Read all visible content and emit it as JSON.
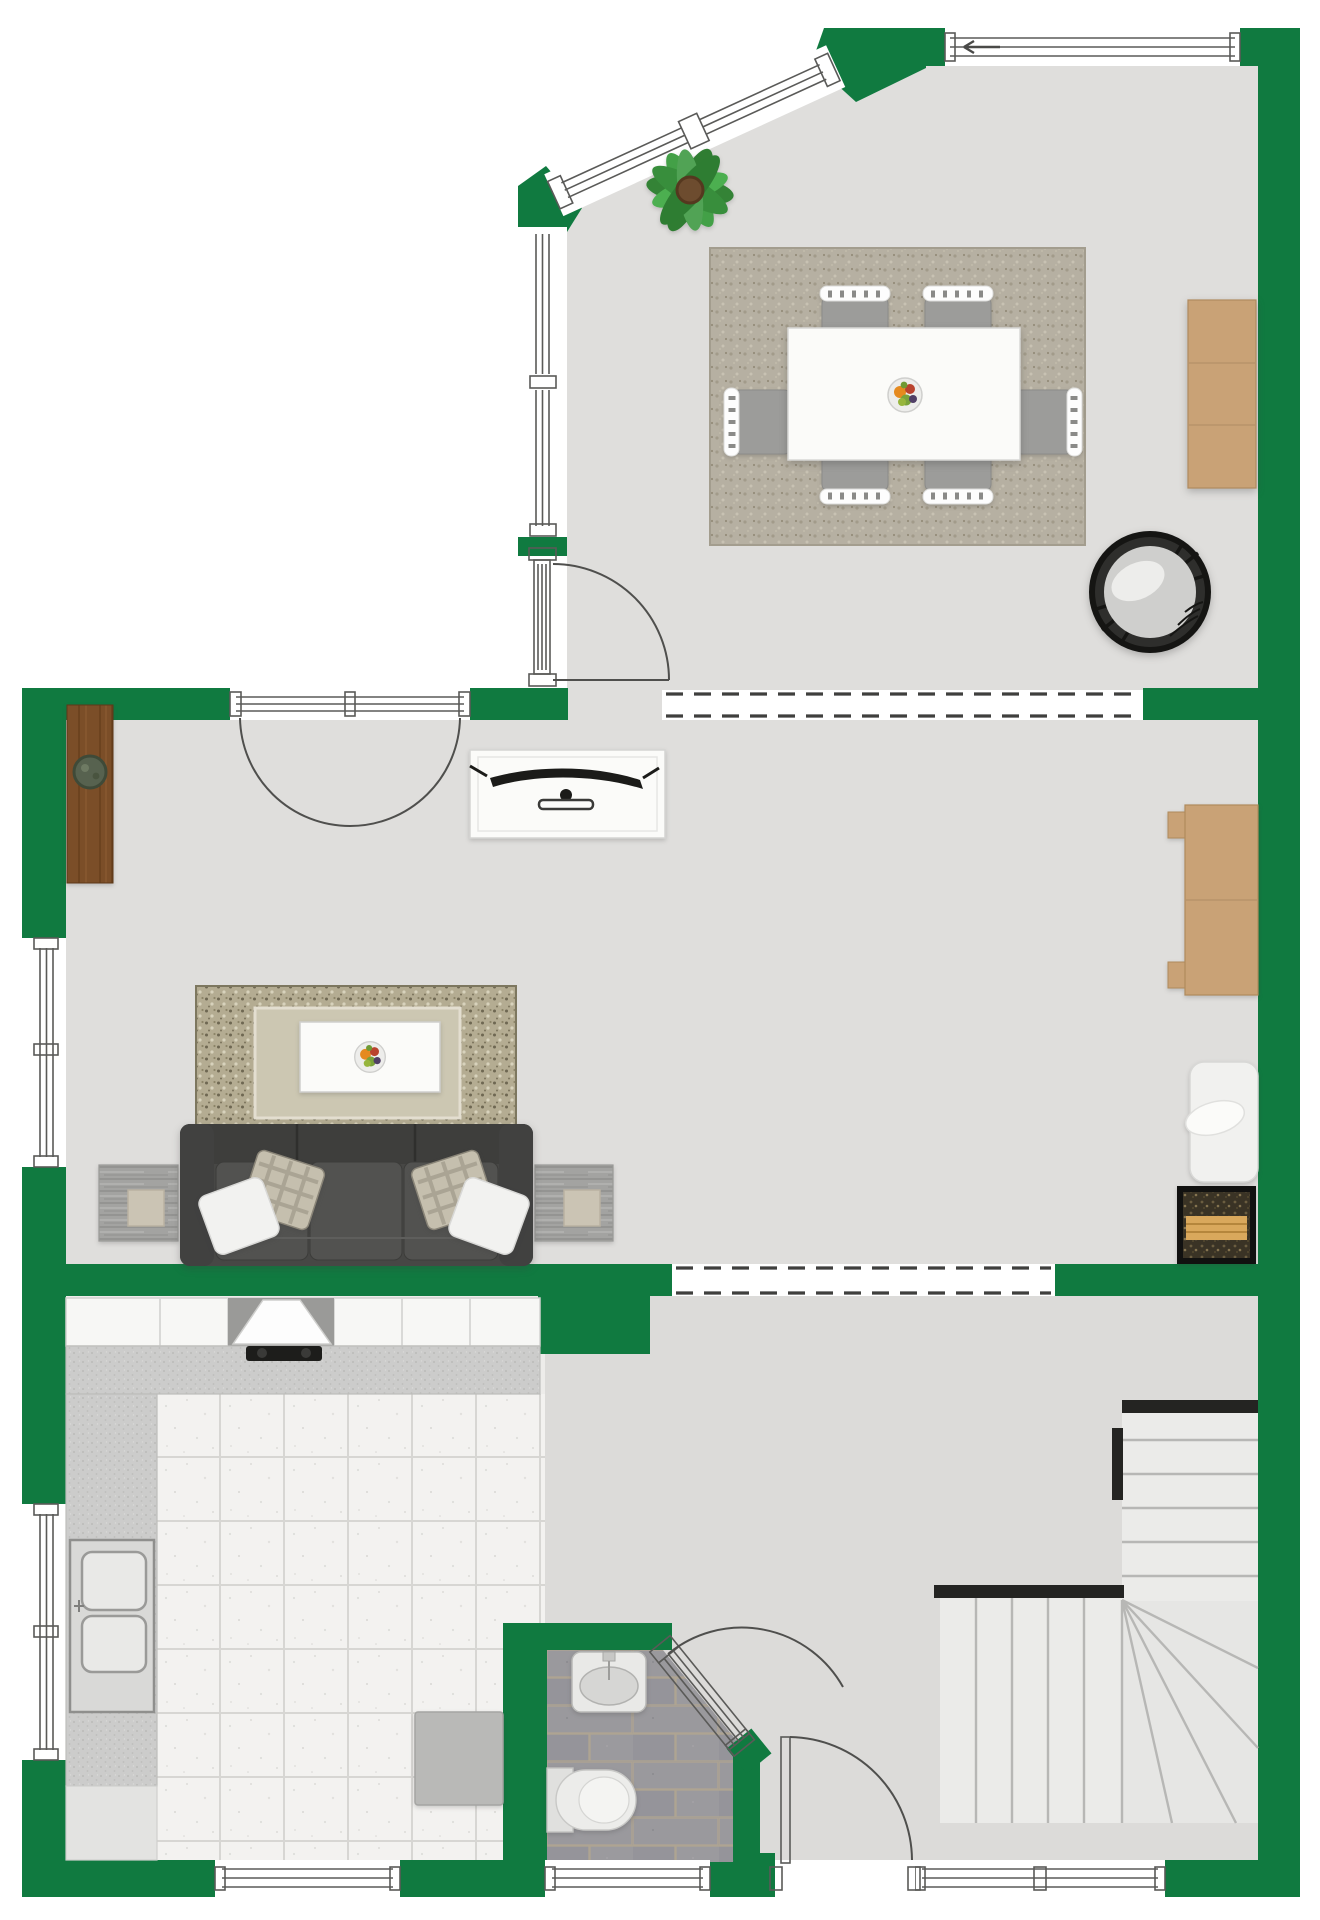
{
  "app": {
    "type": "floor-plan",
    "view": "top-down",
    "labels_visible": false
  },
  "colors": {
    "wall": "#107a40",
    "floor": "#dfdedc",
    "floorHall": "#dcdbd9",
    "outside": "#ffffff",
    "line": "#5a5a58",
    "ink": "#1b1b19",
    "furnWhite": "#fbfbf9",
    "tan": "#c9a276",
    "woodDark": "#7b4e28",
    "sofa": "#474745",
    "sofaSeat": "#525250",
    "stairTread": "#ebebe9",
    "counter": "#cccccb",
    "cabinet": "#f7f7f5",
    "stone": "#98979b",
    "rugDining": "#b6b0a2",
    "rugLiving": "#b4ac92",
    "rugInner": "#ccc7b2",
    "fixture": "#ececea"
  },
  "rooms": [
    {
      "id": "dining-room",
      "label": "dining room",
      "furniture": [
        "dining-table",
        "dining-chair x6",
        "fruit-bowl",
        "area-rug",
        "monstera-plant",
        "sideboard",
        "wicker-chair"
      ]
    },
    {
      "id": "living-room",
      "label": "living room",
      "furniture": [
        "sofa",
        "throw-pillows x4",
        "side-table x2",
        "coffee-table",
        "fruit-bowl",
        "area-rug",
        "tv-console",
        "tv",
        "wall-shelf",
        "shelf-plant",
        "desk",
        "lounge-chair",
        "firewood-rack"
      ]
    },
    {
      "id": "kitchen",
      "label": "kitchen",
      "furniture": [
        "upper-cabinets",
        "extractor-hood",
        "cooktop",
        "counter",
        "double-sink",
        "appliance",
        "tiled-floor"
      ]
    },
    {
      "id": "bathroom",
      "label": "bathroom",
      "furniture": [
        "wash-basin",
        "toilet",
        "stone-floor"
      ]
    },
    {
      "id": "hallway",
      "label": "hallway",
      "furniture": [
        "winder-staircase"
      ]
    }
  ],
  "fixtures": {
    "windows": [
      "dining-top-window",
      "diagonal-window-1",
      "diagonal-window-2",
      "dining-left-window",
      "living-left-window",
      "kitchen-left-window",
      "kitchen-bottom-window",
      "bathroom-bottom-window",
      "hallway-bottom-window"
    ],
    "doors": [
      "dining-side-door",
      "french-doors",
      "dining-living-door",
      "bathroom-door",
      "front-door"
    ],
    "openings": [
      "dining-living-passage",
      "living-hallway-passage"
    ],
    "stairs": "l-shaped-winder-staircase",
    "window_opening_arrow": "left"
  }
}
